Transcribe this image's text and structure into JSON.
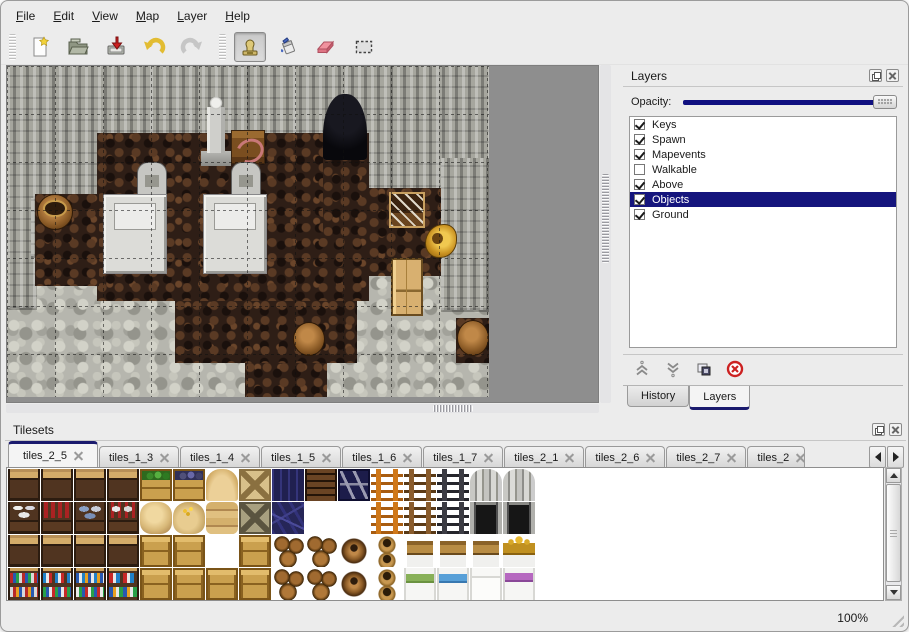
{
  "menu_bar": {
    "items": [
      {
        "label": "File"
      },
      {
        "label": "Edit"
      },
      {
        "label": "View"
      },
      {
        "label": "Map"
      },
      {
        "label": "Layer"
      },
      {
        "label": "Help"
      }
    ]
  },
  "toolbar": {
    "buttons": [
      {
        "icon": "new-file-icon",
        "active": false
      },
      {
        "icon": "open-file-icon",
        "active": false
      },
      {
        "icon": "save-file-icon",
        "active": false
      },
      {
        "icon": "undo-icon",
        "active": false
      },
      {
        "icon": "redo-icon",
        "active": false
      },
      {
        "icon": "stamp-tool-icon",
        "active": true
      },
      {
        "icon": "fill-tool-icon",
        "active": false
      },
      {
        "icon": "eraser-tool-icon",
        "active": false
      },
      {
        "icon": "rect-select-tool-icon",
        "active": false
      }
    ]
  },
  "layers_panel": {
    "title": "Layers",
    "opacity_label": "Opacity:",
    "opacity_percent": 100,
    "layers": [
      {
        "label": "Keys",
        "checked": true,
        "selected": false
      },
      {
        "label": "Spawn",
        "checked": true,
        "selected": false
      },
      {
        "label": "Mapevents",
        "checked": true,
        "selected": false
      },
      {
        "label": "Walkable",
        "checked": false,
        "selected": false
      },
      {
        "label": "Above",
        "checked": true,
        "selected": false
      },
      {
        "label": "Objects",
        "checked": true,
        "selected": true
      },
      {
        "label": "Ground",
        "checked": true,
        "selected": false
      }
    ],
    "action_icons": [
      "raise-layer-icon",
      "lower-layer-icon",
      "duplicate-layer-icon",
      "delete-layer-icon"
    ],
    "bottom_tabs": [
      {
        "label": "History",
        "active": false
      },
      {
        "label": "Layers",
        "active": true
      }
    ]
  },
  "tilesets_panel": {
    "title": "Tilesets",
    "tabs": [
      {
        "label": "tiles_2_5",
        "active": true,
        "truncated": false
      },
      {
        "label": "tiles_1_3",
        "active": false,
        "truncated": false
      },
      {
        "label": "tiles_1_4",
        "active": false,
        "truncated": false
      },
      {
        "label": "tiles_1_5",
        "active": false,
        "truncated": false
      },
      {
        "label": "tiles_1_6",
        "active": false,
        "truncated": false
      },
      {
        "label": "tiles_1_7",
        "active": false,
        "truncated": false
      },
      {
        "label": "tiles_2_1",
        "active": false,
        "truncated": false
      },
      {
        "label": "tiles_2_6",
        "active": false,
        "truncated": false
      },
      {
        "label": "tiles_2_7",
        "active": false,
        "truncated": false
      },
      {
        "label": "tiles_2",
        "active": false,
        "truncated": true
      }
    ],
    "tiles": [
      [
        "shelftop",
        "shelftop",
        "shelftop",
        "shelftop",
        "crate-veg",
        "crate-grape",
        "sack-top",
        "crate-x",
        "navy-top",
        "slat",
        "sign",
        "ladder-o",
        "ladder-b",
        "ladder-g",
        "arch-top",
        "arch-top"
      ],
      [
        "shelf-plates",
        "shelf-red",
        "shelf-blue",
        "shelf-jars",
        "sack",
        "sack-gold",
        "sack-flat",
        "crate-x-dark",
        "navy-planks",
        "empty",
        "empty",
        "ladder-o",
        "ladder-b",
        "ladder-g",
        "arch-bot",
        "arch-bot"
      ],
      [
        "shelftop",
        "shelftop",
        "shelftop",
        "shelftop",
        "crate",
        "crate",
        "empty",
        "crate",
        "barrels",
        "barrels",
        "barrel",
        "pots",
        "bed-head",
        "bed-head",
        "bed-head",
        "bed-crown"
      ],
      [
        "shelf-books",
        "shelf-bottles",
        "shelf-books2",
        "shelf-mixed",
        "crate",
        "crate",
        "crate",
        "crate",
        "barrels",
        "barrels",
        "barrel",
        "pots",
        "bed-green",
        "bed-blue",
        "bed-white",
        "bed-purple"
      ]
    ]
  },
  "map_view": {
    "walls": [
      {
        "x": 0,
        "y": 0,
        "w": 482,
        "h": 132
      },
      {
        "x": 0,
        "y": 132,
        "w": 30,
        "h": 110
      },
      {
        "x": 24,
        "y": 132,
        "w": 72,
        "h": 58
      },
      {
        "x": 352,
        "y": 132,
        "w": 130,
        "h": 60
      },
      {
        "x": 434,
        "y": 92,
        "w": 48,
        "h": 152
      }
    ],
    "floors": [
      {
        "x": 90,
        "y": 67,
        "w": 272,
        "h": 168
      },
      {
        "x": 28,
        "y": 128,
        "w": 64,
        "h": 92
      },
      {
        "x": 316,
        "y": 86,
        "w": 46,
        "h": 84
      },
      {
        "x": 362,
        "y": 122,
        "w": 72,
        "h": 88
      },
      {
        "x": 168,
        "y": 235,
        "w": 182,
        "h": 62
      },
      {
        "x": 238,
        "y": 297,
        "w": 82,
        "h": 68
      },
      {
        "x": 449,
        "y": 252,
        "w": 33,
        "h": 45
      }
    ],
    "objects": [
      {
        "type": "cave-door",
        "x": 316,
        "y": 28,
        "w": 44,
        "h": 66
      },
      {
        "type": "statue",
        "x": 194,
        "y": 30,
        "w": 30,
        "h": 70
      },
      {
        "type": "table",
        "x": 224,
        "y": 64,
        "w": 34,
        "h": 34
      },
      {
        "type": "tombstone",
        "x": 130,
        "y": 96,
        "w": 30,
        "h": 36
      },
      {
        "type": "tombstone",
        "x": 224,
        "y": 96,
        "w": 30,
        "h": 36
      },
      {
        "type": "bier",
        "x": 96,
        "y": 128,
        "w": 64,
        "h": 80
      },
      {
        "type": "bier",
        "x": 196,
        "y": 128,
        "w": 64,
        "h": 80
      },
      {
        "type": "barrel-open",
        "x": 30,
        "y": 128,
        "w": 36,
        "h": 36
      },
      {
        "type": "crate-tools",
        "x": 382,
        "y": 126,
        "w": 36,
        "h": 36
      },
      {
        "type": "gold-horn",
        "x": 418,
        "y": 158,
        "w": 32,
        "h": 34
      },
      {
        "type": "cabinet",
        "x": 384,
        "y": 192,
        "w": 32,
        "h": 58
      },
      {
        "type": "barrel",
        "x": 286,
        "y": 256,
        "w": 32,
        "h": 34
      },
      {
        "type": "barrel",
        "x": 450,
        "y": 254,
        "w": 32,
        "h": 36
      }
    ],
    "grid_size": 48
  },
  "status_bar": {
    "zoom": "100%"
  },
  "icons": [
    "window-float-icon",
    "window-close-icon",
    "tab-close-icon",
    "scroll-up-icon",
    "scroll-down-icon",
    "tab-scroll-left-icon",
    "tab-scroll-right-icon",
    "resize-grip-icon"
  ],
  "colors": {
    "selection": "#15157d",
    "slider_fill": "#101080",
    "tab_accent": "#1b1b6e",
    "delete_red": "#cc2222",
    "map_backdrop": "#8e8e8e"
  }
}
